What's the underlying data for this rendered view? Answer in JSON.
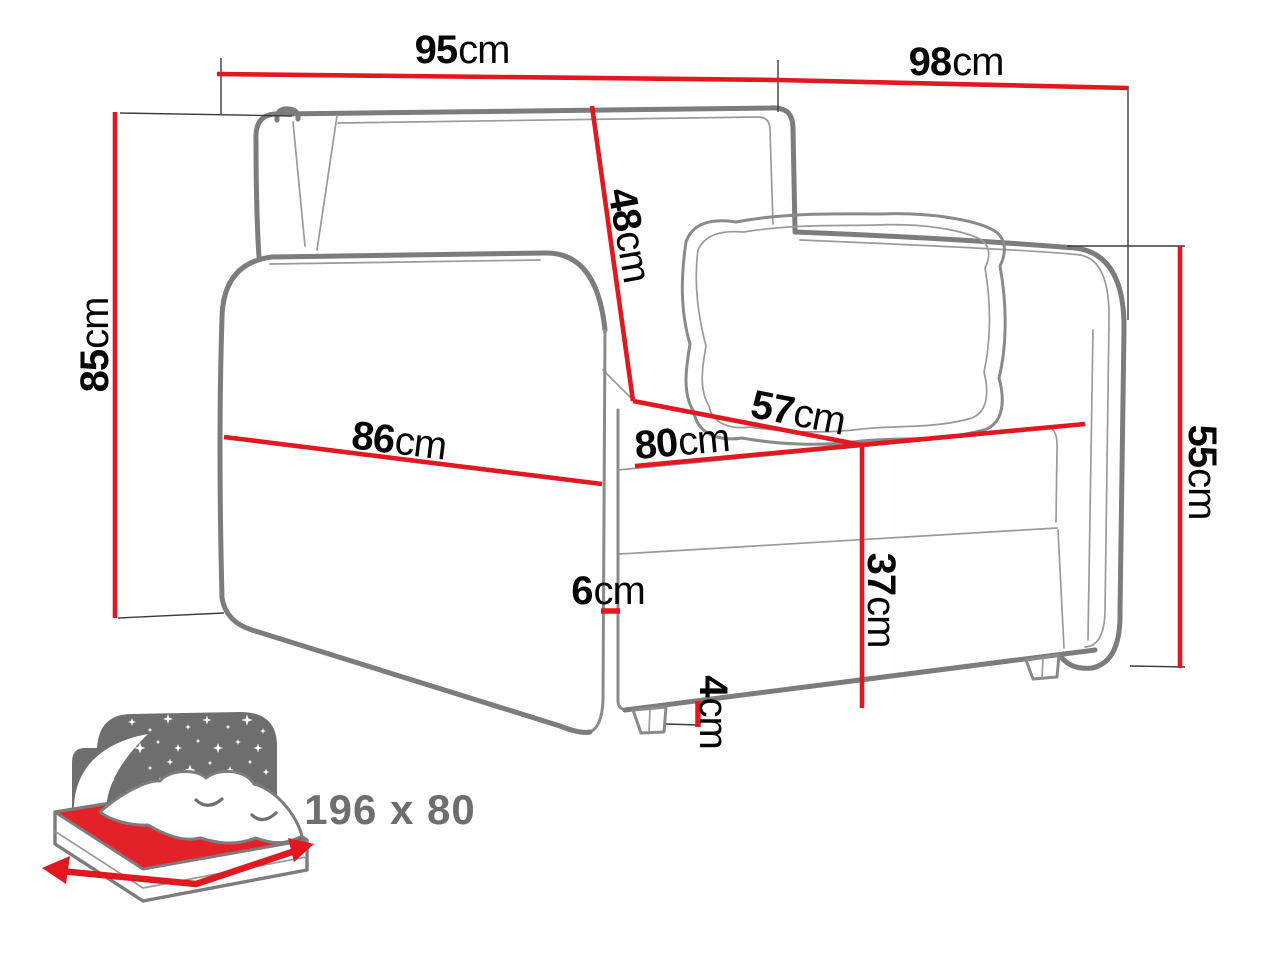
{
  "diagram": {
    "type": "furniture-dimension-drawing",
    "product": "armchair sofa bed",
    "dimensions": {
      "back_width": {
        "value": "95",
        "unit": "cm"
      },
      "total_width": {
        "value": "98",
        "unit": "cm"
      },
      "backrest_height": {
        "value": "48",
        "unit": "cm"
      },
      "total_height": {
        "value": "85",
        "unit": "cm"
      },
      "front_width": {
        "value": "86",
        "unit": "cm"
      },
      "seat_width": {
        "value": "80",
        "unit": "cm"
      },
      "seat_depth": {
        "value": "57",
        "unit": "cm"
      },
      "armrest_height": {
        "value": "55",
        "unit": "cm"
      },
      "armrest_gap": {
        "value": "6",
        "unit": "cm"
      },
      "base_height": {
        "value": "37",
        "unit": "cm"
      },
      "leg_height": {
        "value": "4",
        "unit": "cm"
      }
    },
    "sleeping_area": {
      "label": "196 x 80"
    },
    "colors": {
      "dimension_line": "#e1181f",
      "outline_gray": "#7c7c7c",
      "icon_gray": "#6e6e6e",
      "mattress_red": "#e42028",
      "label_text": "#060606"
    }
  }
}
